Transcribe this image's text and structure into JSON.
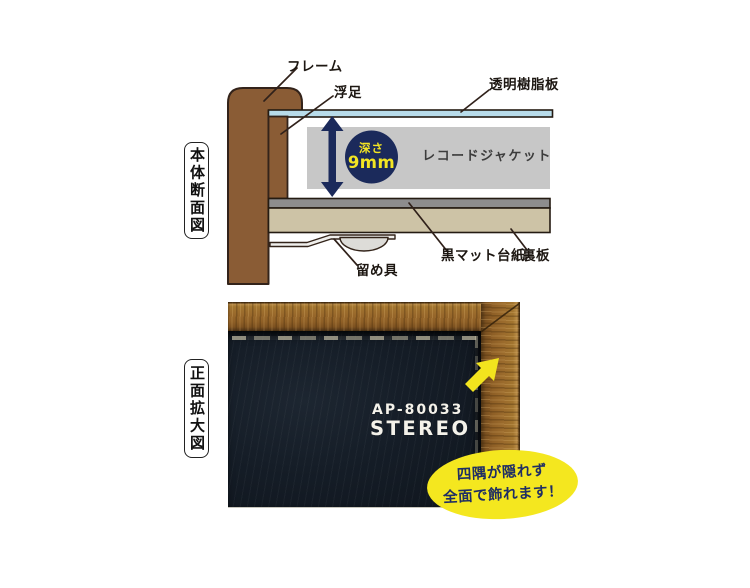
{
  "cross_section": {
    "side_label": "本体断面図",
    "label_frame": "フレーム",
    "label_float_gap": "浮足",
    "label_clear_resin_plate": "透明樹脂板",
    "label_record_jacket": "レコードジャケット",
    "depth_label": "深さ",
    "depth_value": "9mm",
    "label_black_mat_board": "黒マット台紙",
    "label_back_board": "裏板",
    "label_fastener": "留め具",
    "colors": {
      "wood_brown": "#8a5c35",
      "outline_dark": "#33231a",
      "resin_blue": "#b8dcea",
      "jacket_gray": "#c7c7c7",
      "mat_gray": "#8d8d8d",
      "backboard_tan": "#cdc3a6",
      "navy": "#1b2a5b",
      "depth_text_yellow": "#f3e523"
    }
  },
  "front_view": {
    "side_label": "正面拡大図",
    "jacket_print_line1": "AP-80033",
    "jacket_print_line2": "STEREO",
    "callout_line1": "四隅が隠れず",
    "callout_line2": "全面で飾れます！",
    "colors": {
      "callout_yellow": "#f4e71f",
      "callout_text_navy": "#1f2e64",
      "arrow_yellow": "#f2e41e",
      "photo_wood": "#9a6a2c",
      "photo_jacket": "#141c26"
    }
  }
}
